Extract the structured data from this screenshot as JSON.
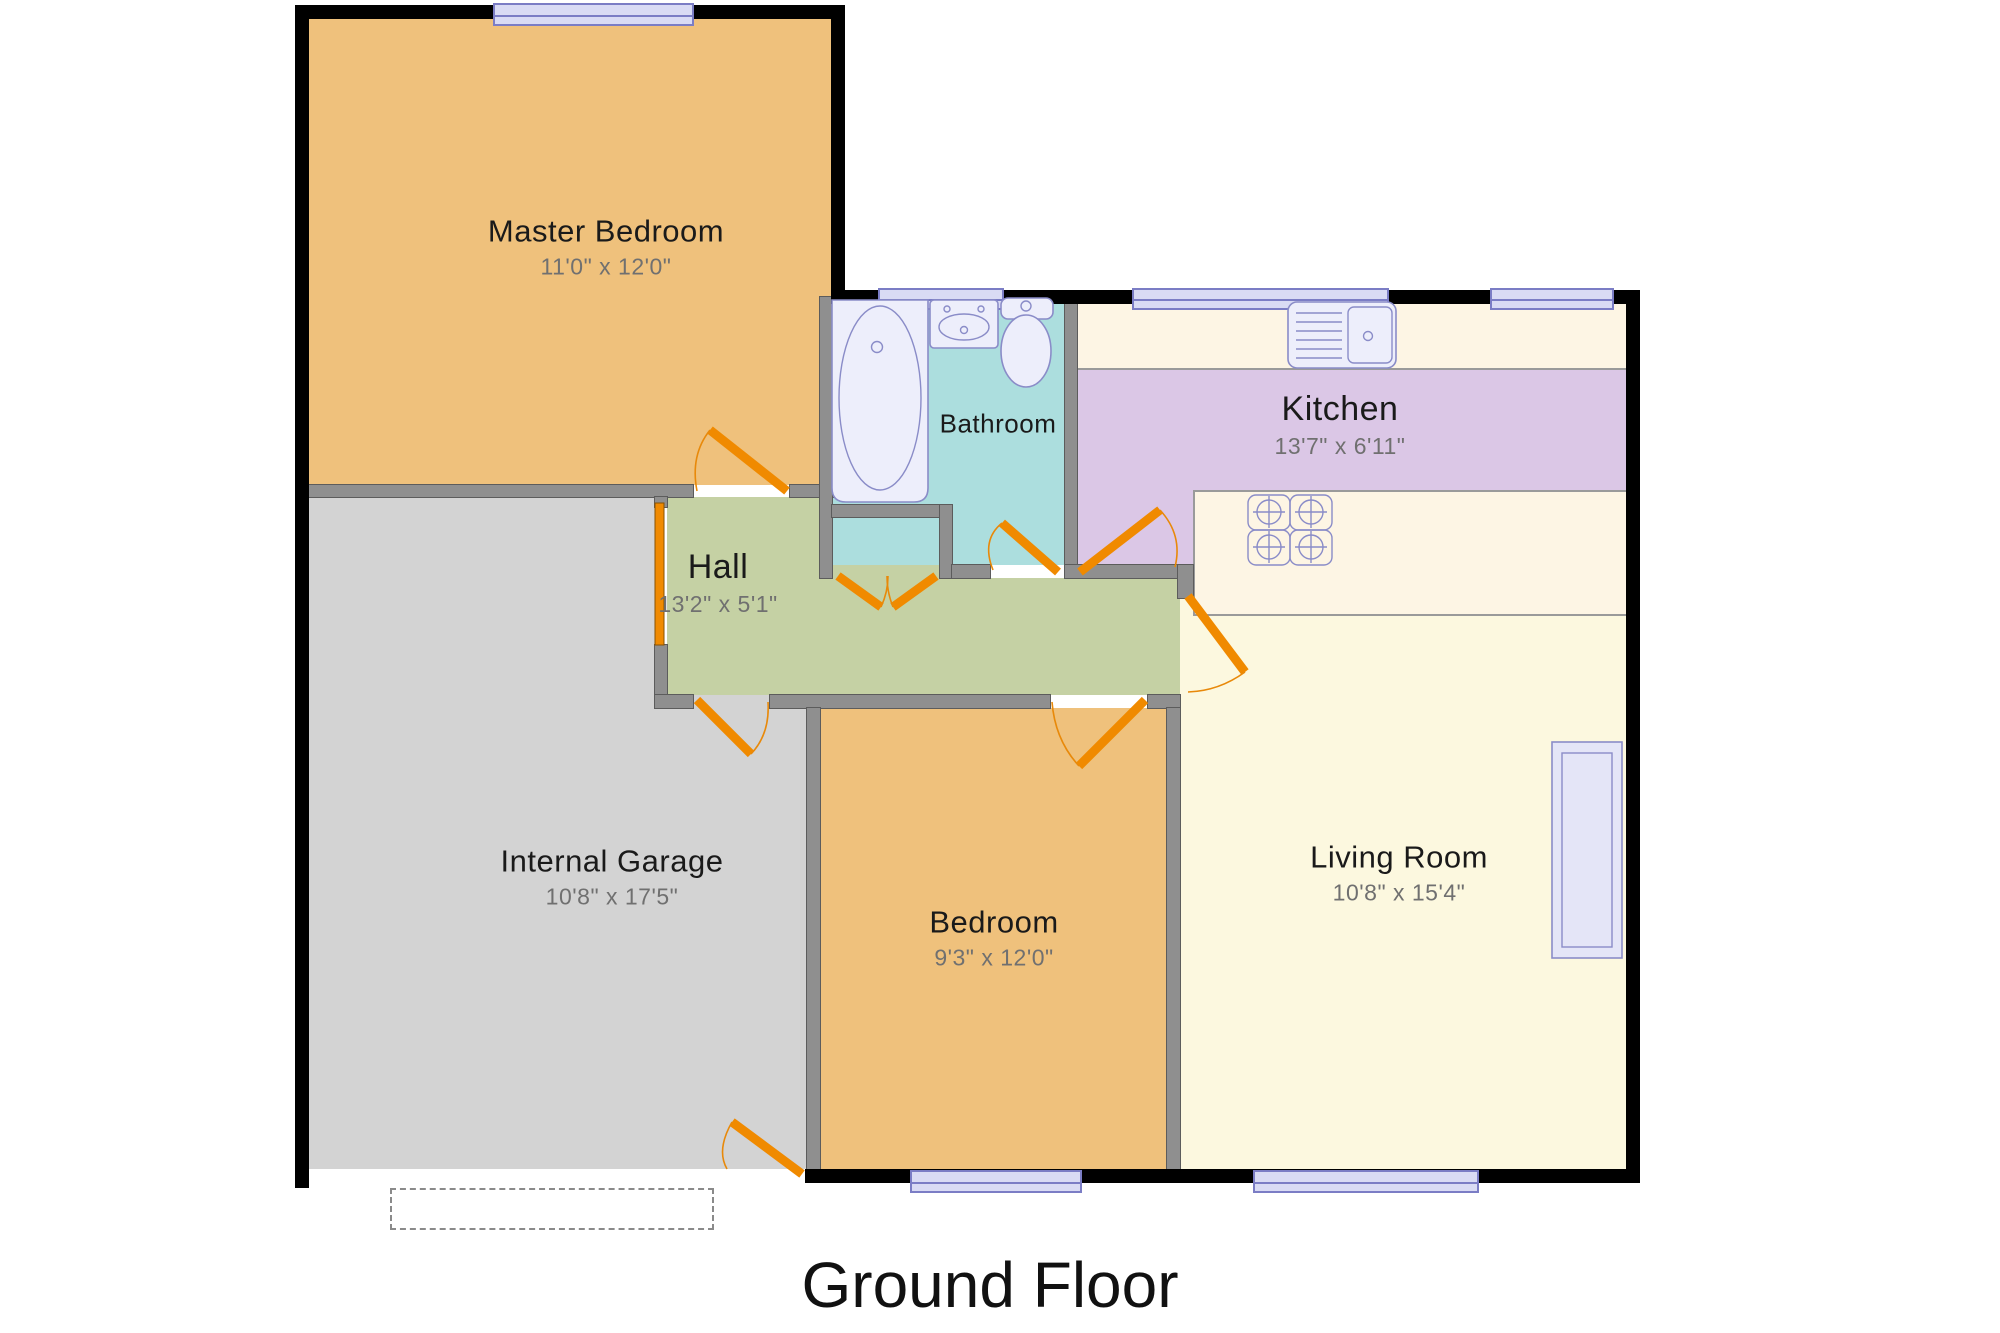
{
  "title": "Ground Floor",
  "rooms": {
    "master_bedroom": {
      "name": "Master Bedroom",
      "dims": "11'0\" x 12'0\""
    },
    "bathroom": {
      "name": "Bathroom"
    },
    "kitchen": {
      "name": "Kitchen",
      "dims": "13'7\" x 6'11\""
    },
    "hall": {
      "name": "Hall",
      "dims": "13'2\" x 5'1\""
    },
    "internal_garage": {
      "name": "Internal Garage",
      "dims": "10'8\" x 17'5\""
    },
    "bedroom": {
      "name": "Bedroom",
      "dims": "9'3\" x 12'0\""
    },
    "living_room": {
      "name": "Living Room",
      "dims": "10'8\" x 15'4\""
    }
  },
  "colors": {
    "room_master_bedroom": "#EFC17C",
    "room_bedroom": "#EFC17C",
    "room_bathroom": "#ACDEDE",
    "room_kitchen": "#DBC7E6",
    "room_kitchen_counter": "#FDF5E4",
    "room_hall": "#C5D1A4",
    "room_garage": "#D3D3D3",
    "room_living": "#FCF8DF",
    "wall_exterior": "#000000",
    "wall_interior": "#8F8F8F",
    "door": "#F08A00",
    "window_fill": "#D9DBF4",
    "window_border": "#7B7DC5",
    "fixture_fill": "#EDEEFB",
    "fixture_border": "#8A8CC8",
    "label_text": "#1a1a1a",
    "dims_text": "#707070"
  }
}
